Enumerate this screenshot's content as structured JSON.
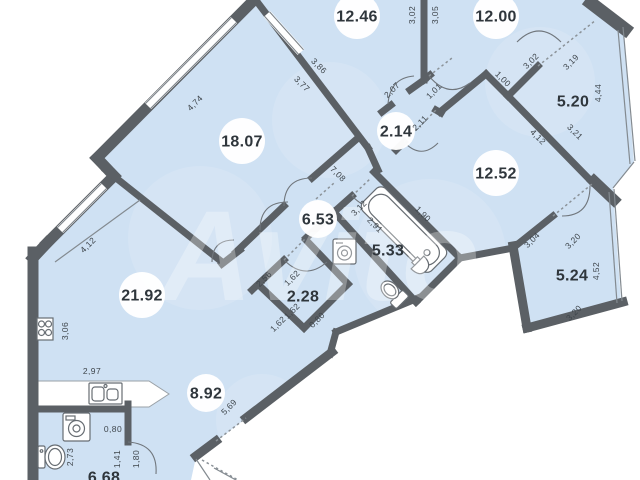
{
  "title": "Apartment floor plan",
  "watermark": "Avito",
  "colors": {
    "room_fill": "#cfe1f3",
    "wall": "#5b6065",
    "dotted": "#8b9298",
    "area_text": "#2f363c",
    "dimension_text": "#3f464c",
    "background": "#ffffff"
  },
  "icons": [
    "bathtub-icon",
    "toilet-icon",
    "pedestal-sink-icon",
    "washing-machine-icon",
    "stove-icon",
    "kitchen-sink-icon",
    "door-arc-icon",
    "window-glazing-icon"
  ],
  "plan": {
    "rooms": [
      {
        "area": "12.46",
        "x": 357,
        "y": 16,
        "badge": true
      },
      {
        "area": "12.00",
        "x": 496,
        "y": 16,
        "badge": true
      },
      {
        "area": "5.20",
        "x": 573,
        "y": 101,
        "badge": false
      },
      {
        "area": "18.07",
        "x": 242,
        "y": 141,
        "badge": true
      },
      {
        "area": "2.14",
        "x": 396,
        "y": 131,
        "badge": true
      },
      {
        "area": "12.52",
        "x": 496,
        "y": 173,
        "badge": true
      },
      {
        "area": "6.53",
        "x": 318,
        "y": 219,
        "badge": true
      },
      {
        "area": "5.33",
        "x": 388,
        "y": 250,
        "badge": false
      },
      {
        "area": "21.92",
        "x": 142,
        "y": 295,
        "badge": true
      },
      {
        "area": "2.28",
        "x": 303,
        "y": 296,
        "badge": false
      },
      {
        "area": "5.24",
        "x": 572,
        "y": 275,
        "badge": false
      },
      {
        "area": "8.92",
        "x": 206,
        "y": 393,
        "badge": true
      },
      {
        "area": "6.68",
        "x": 104,
        "y": 477,
        "badge": false
      }
    ],
    "dimensions": [
      {
        "v": "4,74",
        "x": 197,
        "y": 105,
        "a": -45
      },
      {
        "v": "3,86",
        "x": 317,
        "y": 68,
        "a": 45
      },
      {
        "v": "3,77",
        "x": 300,
        "y": 86,
        "a": 45
      },
      {
        "v": "3,02",
        "x": 415,
        "y": 15,
        "a": -90
      },
      {
        "v": "3,05",
        "x": 438,
        "y": 15,
        "a": -90
      },
      {
        "v": "2,07",
        "x": 394,
        "y": 92,
        "a": -45
      },
      {
        "v": "1,01",
        "x": 436,
        "y": 93,
        "a": -45
      },
      {
        "v": "2,11",
        "x": 422,
        "y": 125,
        "a": -45
      },
      {
        "v": "1,00",
        "x": 501,
        "y": 81,
        "a": 45
      },
      {
        "v": "3,02",
        "x": 533,
        "y": 63,
        "a": -45
      },
      {
        "v": "3,19",
        "x": 573,
        "y": 64,
        "a": -45
      },
      {
        "v": "4,44",
        "x": 601,
        "y": 93,
        "a": -90
      },
      {
        "v": "4,12",
        "x": 536,
        "y": 139,
        "a": 45
      },
      {
        "v": "3,21",
        "x": 573,
        "y": 134,
        "a": 45
      },
      {
        "v": "7,08",
        "x": 336,
        "y": 176,
        "a": 45
      },
      {
        "v": "3,12",
        "x": 361,
        "y": 210,
        "a": -45
      },
      {
        "v": "2,91",
        "x": 373,
        "y": 227,
        "a": 45
      },
      {
        "v": "1,90",
        "x": 421,
        "y": 216,
        "a": 45
      },
      {
        "v": "3,04",
        "x": 534,
        "y": 242,
        "a": -45
      },
      {
        "v": "3,20",
        "x": 575,
        "y": 243,
        "a": -45
      },
      {
        "v": "4,52",
        "x": 599,
        "y": 271,
        "a": -90
      },
      {
        "v": "3,20",
        "x": 576,
        "y": 315,
        "a": -45
      },
      {
        "v": "4,12",
        "x": 90,
        "y": 247,
        "a": -45
      },
      {
        "v": "3,06",
        "x": 68,
        "y": 331,
        "a": -90
      },
      {
        "v": "2,97",
        "x": 92,
        "y": 374,
        "a": 0
      },
      {
        "v": "2,56",
        "x": 266,
        "y": 281,
        "a": -45
      },
      {
        "v": "1,62",
        "x": 294,
        "y": 280,
        "a": -45
      },
      {
        "v": "1,62",
        "x": 294,
        "y": 313,
        "a": -45
      },
      {
        "v": "0,80",
        "x": 319,
        "y": 322,
        "a": -45
      },
      {
        "v": "1,62",
        "x": 280,
        "y": 326,
        "a": -45
      },
      {
        "v": "5,69",
        "x": 231,
        "y": 409,
        "a": -45
      },
      {
        "v": "0,80",
        "x": 113,
        "y": 432,
        "a": 0
      },
      {
        "v": "2,73",
        "x": 73,
        "y": 457,
        "a": -90
      },
      {
        "v": "1,41",
        "x": 120,
        "y": 459,
        "a": -90
      },
      {
        "v": "1,80",
        "x": 139,
        "y": 459,
        "a": -90
      }
    ]
  }
}
